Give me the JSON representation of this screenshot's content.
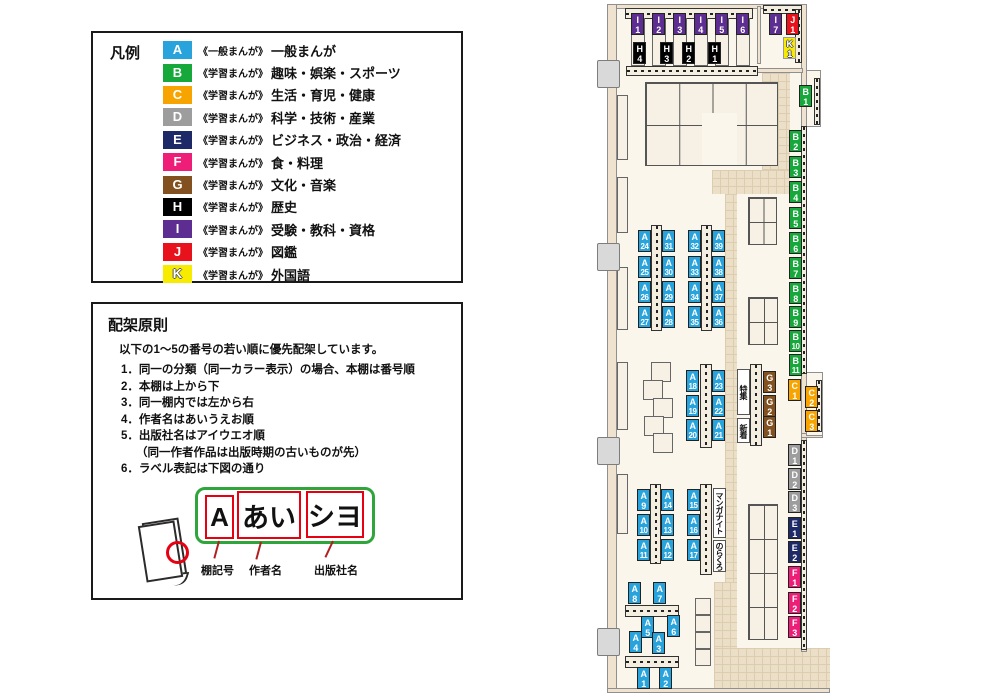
{
  "legend": {
    "title": "凡例",
    "items": [
      {
        "code": "A",
        "color": "#29A3DC",
        "series": "《一般まんが》",
        "label": "一般まんが"
      },
      {
        "code": "B",
        "color": "#17A83C",
        "series": "《学習まんが》",
        "label": "趣味・娯楽・スポーツ"
      },
      {
        "code": "C",
        "color": "#F7A400",
        "series": "《学習まんが》",
        "label": "生活・育児・健康"
      },
      {
        "code": "D",
        "color": "#9D9D9E",
        "series": "《学習まんが》",
        "label": "科学・技術・産業"
      },
      {
        "code": "E",
        "color": "#1E2A68",
        "series": "《学習まんが》",
        "label": "ビジネス・政治・経済"
      },
      {
        "code": "F",
        "color": "#EE1E78",
        "series": "《学習まんが》",
        "label": "食・料理"
      },
      {
        "code": "G",
        "color": "#83501F",
        "series": "《学習まんが》",
        "label": "文化・音楽"
      },
      {
        "code": "H",
        "color": "#000000",
        "series": "《学習まんが》",
        "label": "歴史"
      },
      {
        "code": "I",
        "color": "#5E2D91",
        "series": "《学習まんが》",
        "label": "受験・教科・資格"
      },
      {
        "code": "J",
        "color": "#E8121C",
        "series": "《学習まんが》",
        "label": "図鑑"
      },
      {
        "code": "K",
        "color": "#F7EC00",
        "series": "《学習まんが》",
        "label": "外国語",
        "outline_text": true
      }
    ]
  },
  "principles": {
    "title": "配架原則",
    "intro": "以下の1〜5の番号の若い順に優先配架しています。",
    "items": [
      {
        "text": "1．同一の分類（同一カラー表示）の場合、本棚は番号順"
      },
      {
        "text": "2．本棚は上から下"
      },
      {
        "text": "3．同一棚内では左から右"
      },
      {
        "text": "4．作者名はあいうえお順"
      },
      {
        "text": "5．出版社名はアイウエオ順"
      },
      {
        "text": "（同一作者作品は出版時期の古いものが先）",
        "indent": true
      },
      {
        "text": "6．ラベル表記は下図の通り"
      }
    ],
    "label_diagram": {
      "boxes": [
        "A",
        "あい",
        "シヨ"
      ],
      "captions": [
        "棚記号",
        "作者名",
        "出版社名"
      ]
    }
  },
  "map": {
    "categories": {
      "A": "#29A3DC",
      "B": "#17A83C",
      "C": "#F7A400",
      "D": "#9D9D9E",
      "E": "#1E2A68",
      "F": "#EE1E78",
      "G": "#83501F",
      "H": "#000000",
      "I": "#5E2D91",
      "J": "#E8121C",
      "K": "#F7EC00"
    },
    "shelf_labels": [
      {
        "id": "I1",
        "x": 631,
        "y": 13
      },
      {
        "id": "I2",
        "x": 652,
        "y": 13
      },
      {
        "id": "I3",
        "x": 673,
        "y": 13
      },
      {
        "id": "I4",
        "x": 694,
        "y": 13
      },
      {
        "id": "I5",
        "x": 715,
        "y": 13
      },
      {
        "id": "I6",
        "x": 736,
        "y": 13
      },
      {
        "id": "I7",
        "x": 769,
        "y": 13
      },
      {
        "id": "J1",
        "x": 786,
        "y": 13
      },
      {
        "id": "K1",
        "x": 783,
        "y": 37
      },
      {
        "id": "H4",
        "x": 633,
        "y": 42
      },
      {
        "id": "H3",
        "x": 660,
        "y": 42
      },
      {
        "id": "H2",
        "x": 682,
        "y": 42
      },
      {
        "id": "H1",
        "x": 708,
        "y": 42
      },
      {
        "id": "B1",
        "x": 799,
        "y": 85
      },
      {
        "id": "B2",
        "x": 789,
        "y": 130
      },
      {
        "id": "B3",
        "x": 789,
        "y": 156
      },
      {
        "id": "B4",
        "x": 789,
        "y": 181
      },
      {
        "id": "B5",
        "x": 789,
        "y": 207
      },
      {
        "id": "B6",
        "x": 789,
        "y": 232
      },
      {
        "id": "B7",
        "x": 789,
        "y": 257
      },
      {
        "id": "B8",
        "x": 789,
        "y": 282
      },
      {
        "id": "B9",
        "x": 789,
        "y": 306
      },
      {
        "id": "B10",
        "x": 789,
        "y": 330
      },
      {
        "id": "B11",
        "x": 789,
        "y": 354
      },
      {
        "id": "C1",
        "x": 788,
        "y": 379
      },
      {
        "id": "C2",
        "x": 805,
        "y": 386
      },
      {
        "id": "C3",
        "x": 805,
        "y": 410
      },
      {
        "id": "G3",
        "x": 763,
        "y": 371
      },
      {
        "id": "G2",
        "x": 763,
        "y": 395
      },
      {
        "id": "G1",
        "x": 763,
        "y": 416
      },
      {
        "id": "D1",
        "x": 788,
        "y": 444
      },
      {
        "id": "D2",
        "x": 788,
        "y": 468
      },
      {
        "id": "D3",
        "x": 788,
        "y": 491
      },
      {
        "id": "E1",
        "x": 788,
        "y": 517
      },
      {
        "id": "E2",
        "x": 788,
        "y": 541
      },
      {
        "id": "F1",
        "x": 788,
        "y": 566
      },
      {
        "id": "F2",
        "x": 788,
        "y": 592
      },
      {
        "id": "F3",
        "x": 788,
        "y": 616
      },
      {
        "id": "A24",
        "x": 638,
        "y": 230
      },
      {
        "id": "A25",
        "x": 638,
        "y": 256
      },
      {
        "id": "A26",
        "x": 638,
        "y": 281
      },
      {
        "id": "A27",
        "x": 638,
        "y": 306
      },
      {
        "id": "A31",
        "x": 662,
        "y": 230
      },
      {
        "id": "A30",
        "x": 662,
        "y": 256
      },
      {
        "id": "A29",
        "x": 662,
        "y": 281
      },
      {
        "id": "A28",
        "x": 662,
        "y": 306
      },
      {
        "id": "A32",
        "x": 688,
        "y": 230
      },
      {
        "id": "A33",
        "x": 688,
        "y": 256
      },
      {
        "id": "A34",
        "x": 688,
        "y": 281
      },
      {
        "id": "A35",
        "x": 688,
        "y": 306
      },
      {
        "id": "A39",
        "x": 712,
        "y": 230
      },
      {
        "id": "A38",
        "x": 712,
        "y": 256
      },
      {
        "id": "A37",
        "x": 712,
        "y": 281
      },
      {
        "id": "A36",
        "x": 712,
        "y": 306
      },
      {
        "id": "A18",
        "x": 686,
        "y": 370
      },
      {
        "id": "A19",
        "x": 686,
        "y": 395
      },
      {
        "id": "A20",
        "x": 686,
        "y": 419
      },
      {
        "id": "A23",
        "x": 712,
        "y": 370
      },
      {
        "id": "A22",
        "x": 712,
        "y": 395
      },
      {
        "id": "A21",
        "x": 712,
        "y": 419
      },
      {
        "id": "A9",
        "x": 637,
        "y": 489
      },
      {
        "id": "A10",
        "x": 637,
        "y": 514
      },
      {
        "id": "A11",
        "x": 637,
        "y": 539
      },
      {
        "id": "A14",
        "x": 661,
        "y": 489
      },
      {
        "id": "A13",
        "x": 661,
        "y": 514
      },
      {
        "id": "A12",
        "x": 661,
        "y": 539
      },
      {
        "id": "A15",
        "x": 687,
        "y": 489
      },
      {
        "id": "A16",
        "x": 687,
        "y": 514
      },
      {
        "id": "A17",
        "x": 687,
        "y": 539
      },
      {
        "id": "A8",
        "x": 628,
        "y": 582
      },
      {
        "id": "A7",
        "x": 653,
        "y": 582
      },
      {
        "id": "A5",
        "x": 641,
        "y": 616
      },
      {
        "id": "A6",
        "x": 667,
        "y": 615
      },
      {
        "id": "A4",
        "x": 629,
        "y": 631
      },
      {
        "id": "A3",
        "x": 652,
        "y": 632
      },
      {
        "id": "A1",
        "x": 637,
        "y": 667
      },
      {
        "id": "A2",
        "x": 659,
        "y": 667
      }
    ],
    "area_labels": [
      {
        "text": "特集",
        "name": "area-label-featured",
        "x": 737,
        "y": 369,
        "h": 46
      },
      {
        "text": "新着",
        "name": "area-label-new-arrivals",
        "x": 737,
        "y": 418,
        "h": 25
      },
      {
        "text": "マンガナイト",
        "name": "area-label-manga-night",
        "x": 713,
        "y": 488,
        "h": 50
      },
      {
        "text": "のらくろ",
        "name": "area-label-norakuro",
        "x": 713,
        "y": 540,
        "h": 32
      }
    ]
  }
}
